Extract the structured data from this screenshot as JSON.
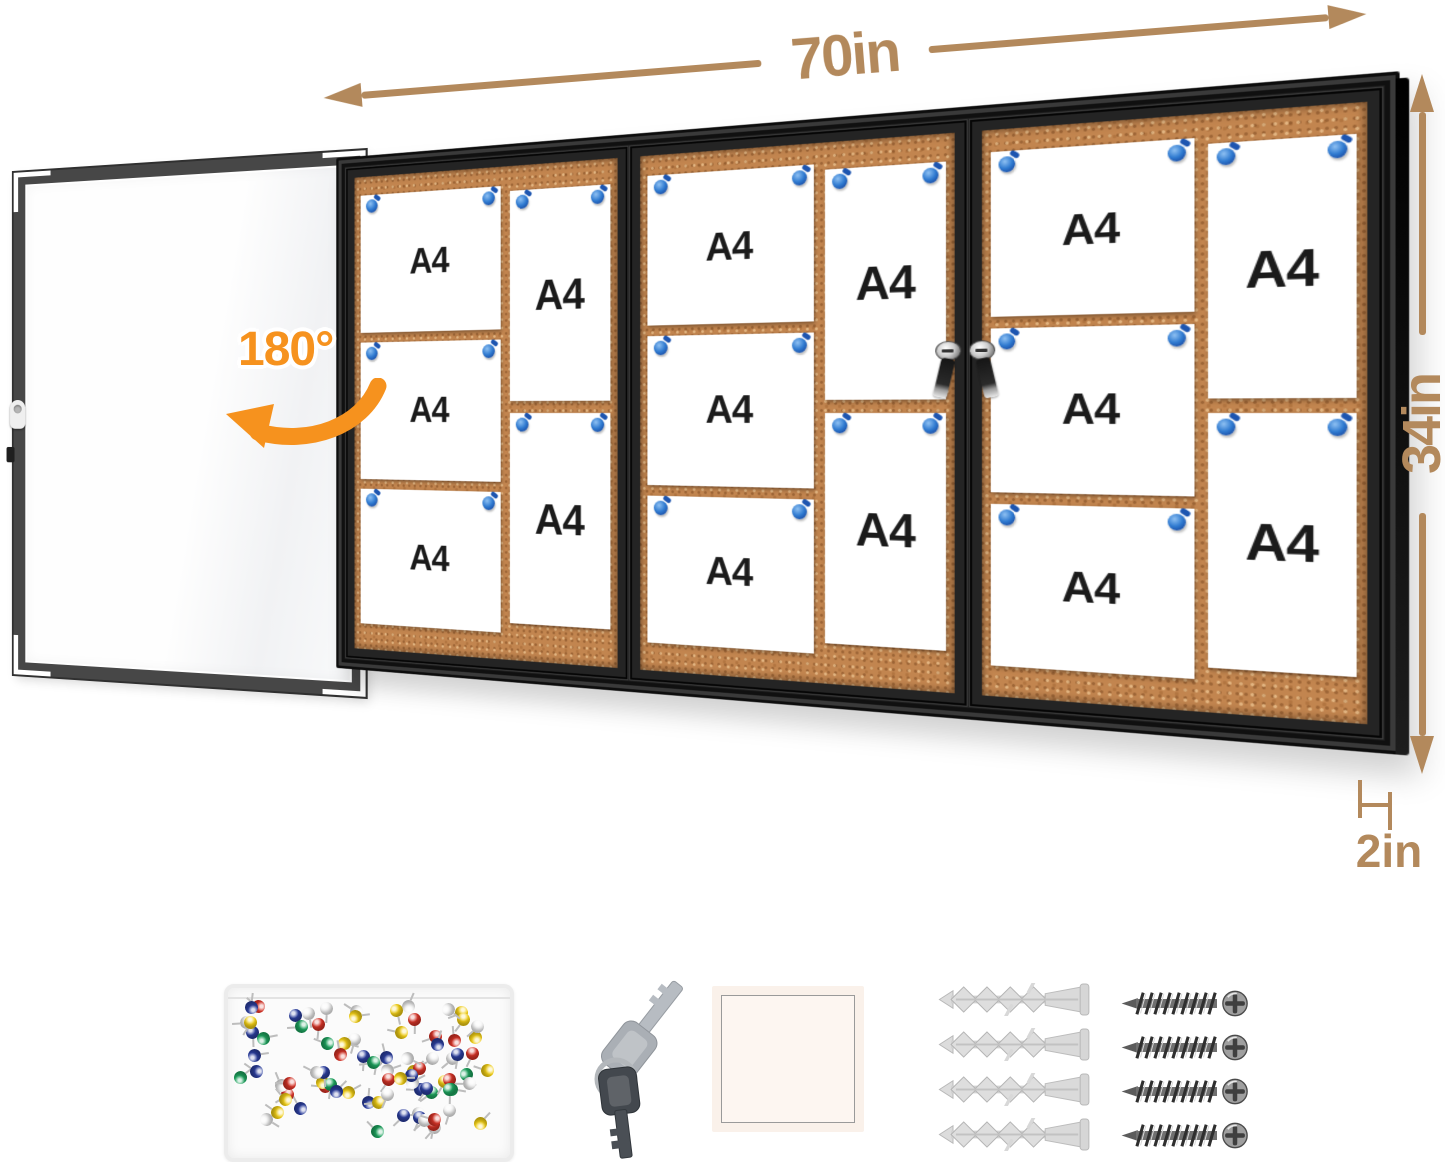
{
  "annotations": {
    "width_label": "70in",
    "height_label": "34in",
    "depth_label": "2in",
    "door_swing_label": "180°"
  },
  "board": {
    "paper_label": "A4",
    "sections": 3,
    "papers_per_section": 5,
    "pins_per_paper": 2,
    "locks_on_divider": 2
  },
  "accessories": [
    {
      "name": "push-pin-box"
    },
    {
      "name": "lock-keys",
      "count": 2
    },
    {
      "name": "adhesive-pad"
    },
    {
      "name": "wall-anchors",
      "count": 4
    },
    {
      "name": "mounting-screws",
      "count": 4
    }
  ],
  "colors": {
    "dimension_text": "#b3895c",
    "accent_orange": "#f6921e",
    "cork": "#c2854f",
    "frame_black": "#222222",
    "pin_blue": "#2a74d2",
    "pushpin_colors": [
      "#d63327",
      "#2c3f9f",
      "#1ea45f",
      "#f2cf16",
      "#f4f4f4"
    ]
  }
}
